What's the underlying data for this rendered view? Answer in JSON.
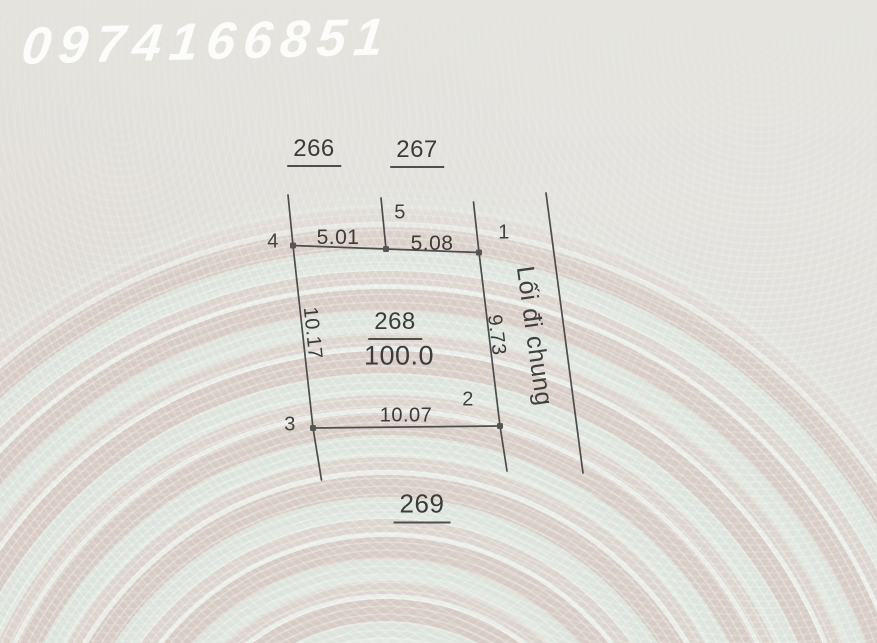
{
  "watermark": {
    "phone": "0974166851"
  },
  "parcel_map": {
    "main_plot": {
      "id": "268",
      "area": "100.0"
    },
    "adjacent_plots": {
      "top_left": "266",
      "top_right": "267",
      "bottom": "269"
    },
    "dimensions": {
      "top_left_edge": "5.01",
      "top_right_edge": "5.08",
      "left_edge": "10.17",
      "right_edge": "9.73",
      "bottom_edge": "10.07"
    },
    "vertices": {
      "v1": "1",
      "v2": "2",
      "v3": "3",
      "v4": "4",
      "v5": "5"
    },
    "easement_label": "Lối đi chung"
  },
  "colors": {
    "paper": "#e5e3de",
    "ring_pink": "#ceb9b0",
    "ring_mint": "#deE8e0",
    "line": "#4d4d4d",
    "text": "#3b3b3b",
    "watermark_text": "#fdfdfb"
  }
}
